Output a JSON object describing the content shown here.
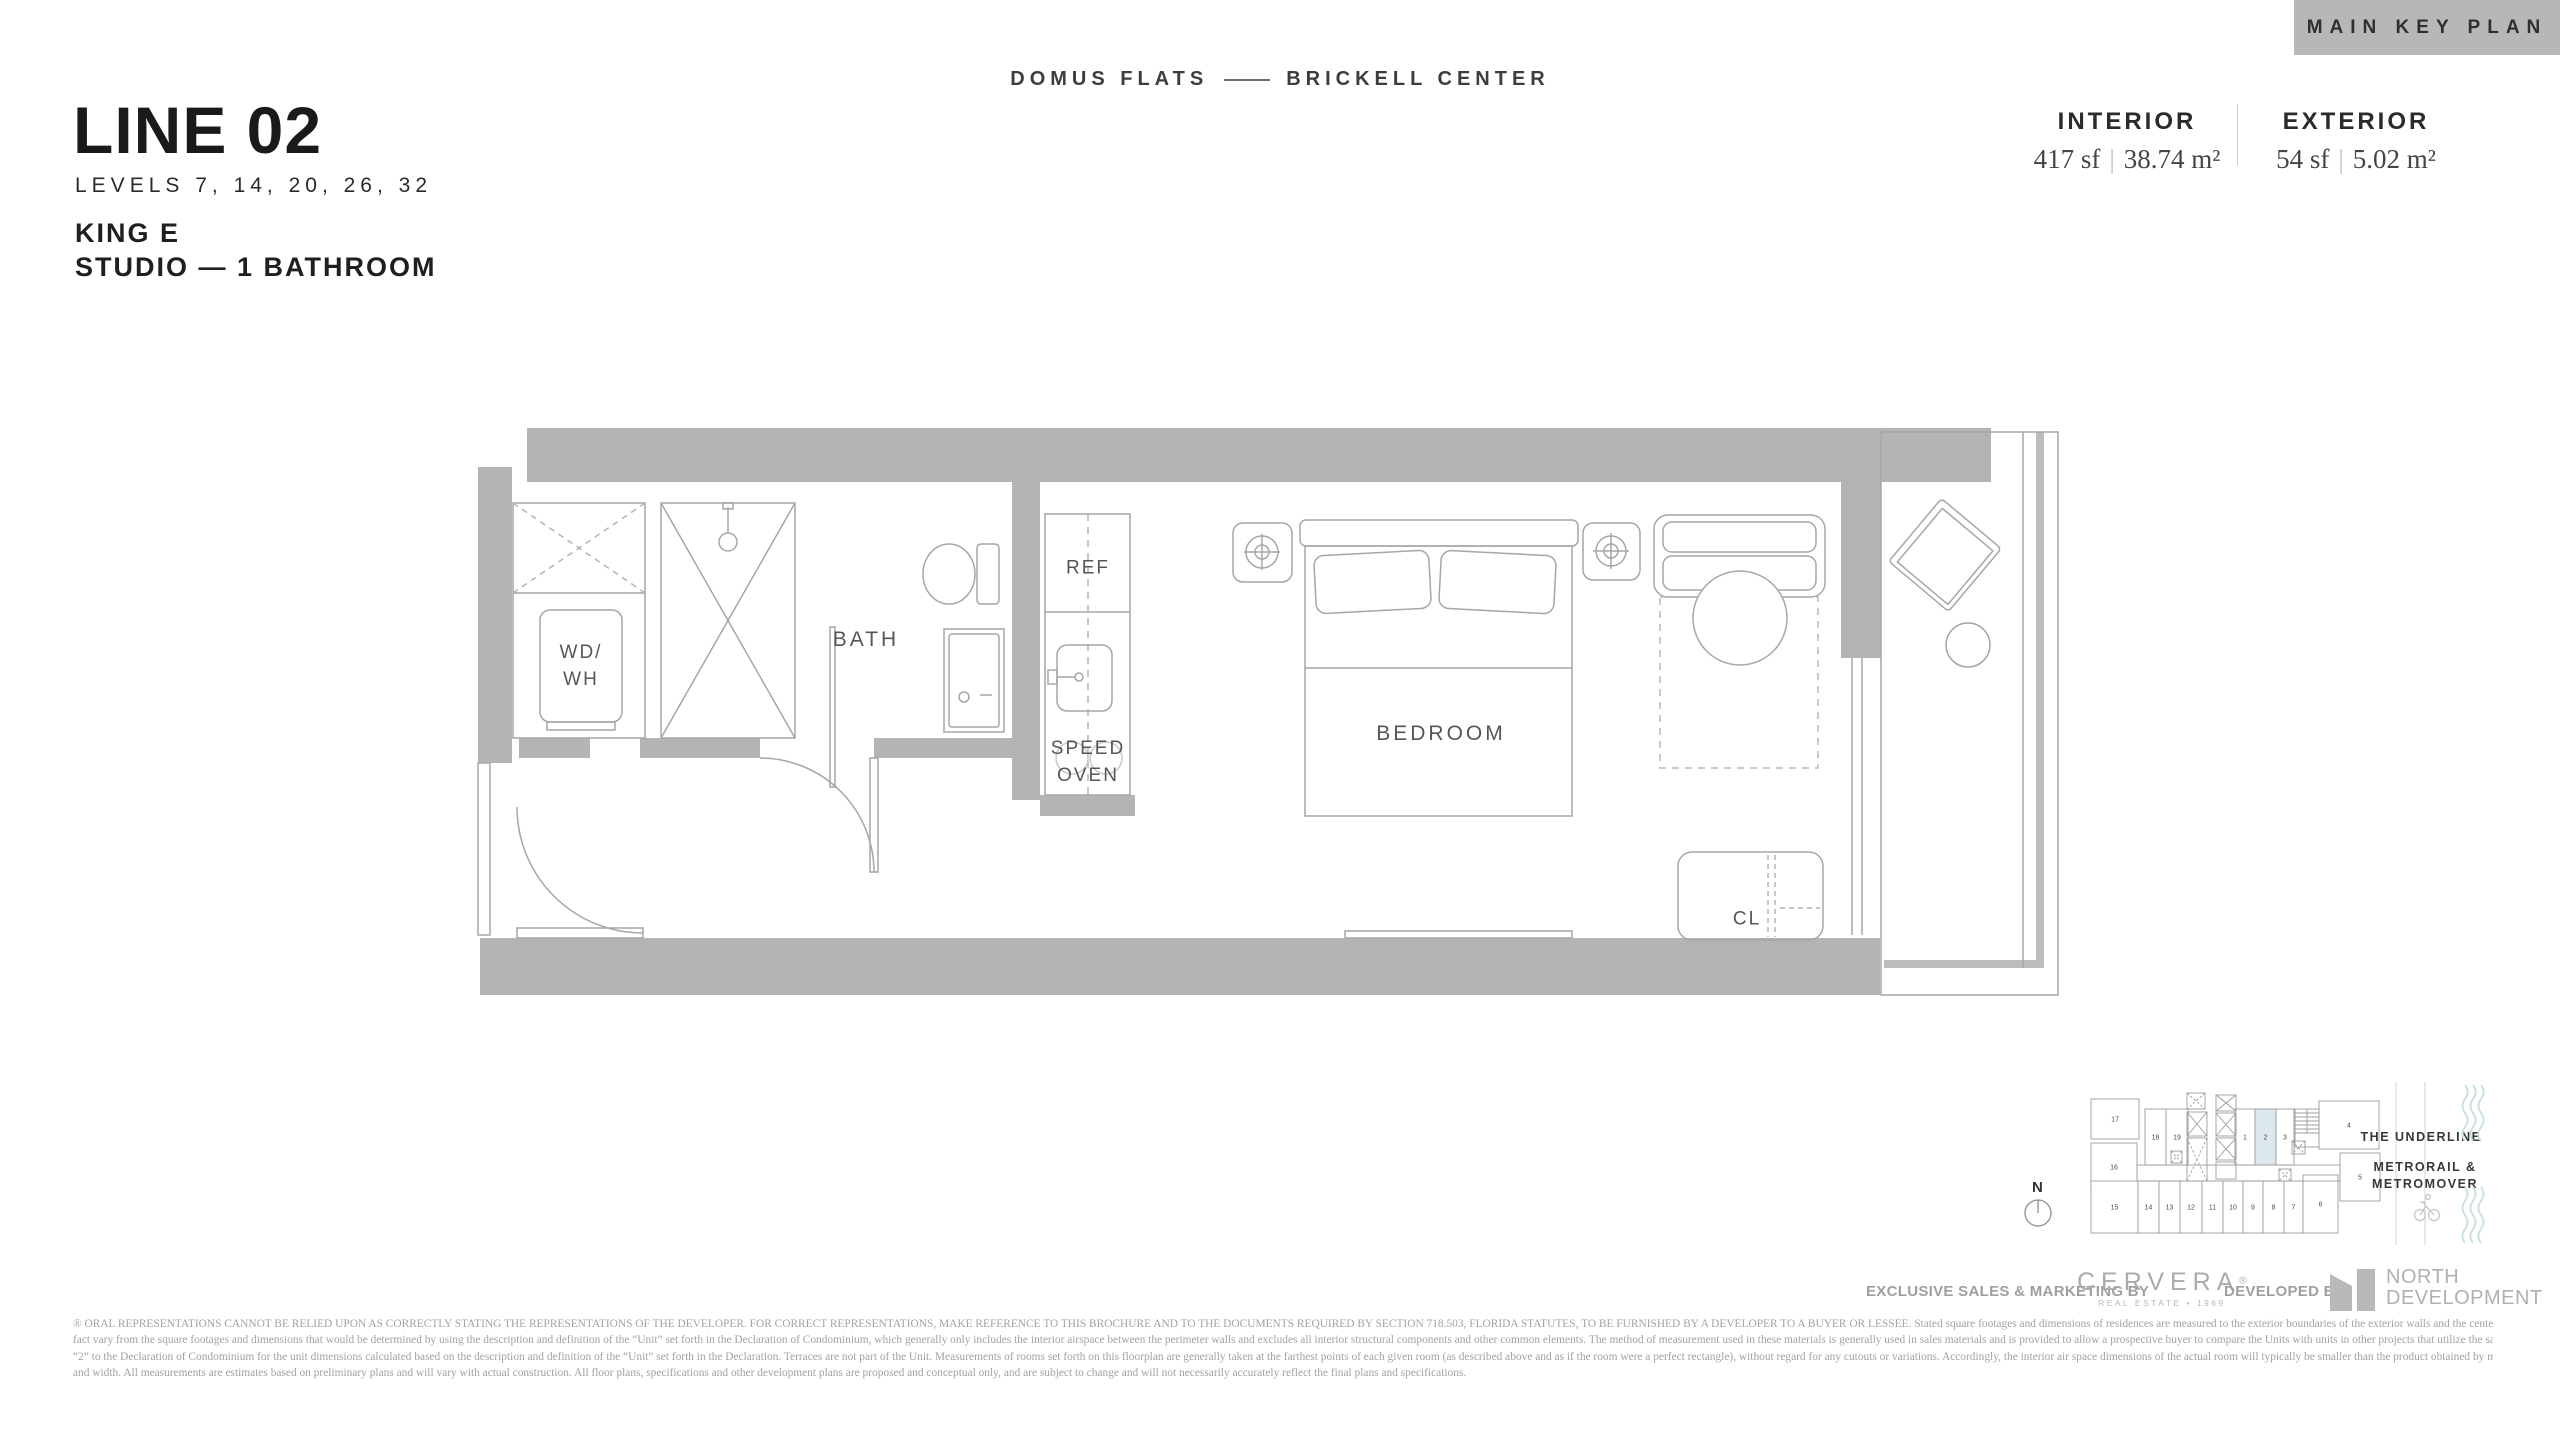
{
  "header": {
    "key_plan_button": "MAIN KEY PLAN",
    "brand_left": "DOMUS FLATS",
    "brand_right": "BRICKELL CENTER"
  },
  "title": {
    "line": "LINE 02",
    "levels": "LEVELS 7, 14, 20, 26, 32",
    "unit_name": "KING E",
    "unit_type": "STUDIO — 1 BATHROOM"
  },
  "areas": {
    "interior_label": "INTERIOR",
    "interior_sf": "417 sf",
    "interior_m2": "38.74 m²",
    "exterior_label": "EXTERIOR",
    "exterior_sf": "54 sf",
    "exterior_m2": "5.02 m²",
    "divider": "|"
  },
  "plan": {
    "labels": {
      "wd1": "WD/",
      "wd2": "WH",
      "bath": "BATH",
      "ref": "REF",
      "speed1": "SPEED",
      "speed2": "OVEN",
      "bedroom": "BEDROOM",
      "cl": "CL"
    }
  },
  "key_plan": {
    "north_label": "N",
    "annotations": {
      "underline": "THE UNDERLINE",
      "metro1": "METRORAIL &",
      "metro2": "METROMOVER"
    },
    "highlight_color": "#dce8ed",
    "highlighted_unit": "2",
    "units": [
      {
        "label": "17",
        "x": 8,
        "y": 14,
        "w": 48,
        "h": 40
      },
      {
        "label": "16",
        "x": 8,
        "y": 58,
        "w": 46,
        "h": 48
      },
      {
        "label": "18",
        "x": 62,
        "y": 24,
        "w": 21,
        "h": 56
      },
      {
        "label": "19",
        "x": 83,
        "y": 24,
        "w": 22,
        "h": 56
      },
      {
        "label": "1",
        "x": 152,
        "y": 24,
        "w": 20,
        "h": 56
      },
      {
        "label": "2",
        "x": 172,
        "y": 24,
        "w": 21,
        "h": 56,
        "highlighted": true
      },
      {
        "label": "3",
        "x": 193,
        "y": 24,
        "w": 18,
        "h": 56
      },
      {
        "label": "4",
        "x": 236,
        "y": 16,
        "w": 60,
        "h": 48
      },
      {
        "label": "5",
        "x": 257,
        "y": 68,
        "w": 40,
        "h": 48
      },
      {
        "label": "15",
        "x": 8,
        "y": 96,
        "w": 47,
        "h": 52
      },
      {
        "label": "14",
        "x": 55,
        "y": 96,
        "w": 21,
        "h": 52
      },
      {
        "label": "13",
        "x": 76,
        "y": 96,
        "w": 21,
        "h": 52
      },
      {
        "label": "12",
        "x": 97,
        "y": 96,
        "w": 22,
        "h": 52
      },
      {
        "label": "11",
        "x": 119,
        "y": 96,
        "w": 21,
        "h": 52
      },
      {
        "label": "10",
        "x": 140,
        "y": 96,
        "w": 20,
        "h": 52
      },
      {
        "label": "9",
        "x": 160,
        "y": 96,
        "w": 20,
        "h": 52
      },
      {
        "label": "8",
        "x": 180,
        "y": 96,
        "w": 21,
        "h": 52
      },
      {
        "label": "7",
        "x": 201,
        "y": 96,
        "w": 19,
        "h": 52
      },
      {
        "label": "6",
        "x": 220,
        "y": 90,
        "w": 35,
        "h": 58
      }
    ]
  },
  "footer": {
    "sales_label": "EXCLUSIVE SALES & MARKETING BY",
    "cervera_name": "CERVERA",
    "cervera_reg": "®",
    "cervera_sub": "REAL ESTATE • 1969",
    "developed_label": "DEVELOPED BY",
    "developer_name1": "NORTH",
    "developer_name2": "DEVELOPMENT"
  },
  "disclaimer": {
    "lines": [
      "® ORAL REPRESENTATIONS CANNOT BE RELIED UPON AS CORRECTLY STATING THE REPRESENTATIONS OF THE DEVELOPER. FOR CORRECT REPRESENTATIONS, MAKE REFERENCE TO THIS BROCHURE AND TO THE DOCUMENTS REQUIRED BY SECTION 718.503, FLORIDA STATUTES, TO BE FURNISHED BY A DEVELOPER TO A BUYER OR LESSEE. Stated square footages and dimensions of residences are measured to the exterior boundaries of the exterior walls and the centerline of interior demising walls between units and in",
      "fact vary from the square footages and dimensions that would be determined by using the description and definition of the “Unit” set forth in the Declaration of Condominium, which generally only includes the interior airspace between the perimeter walls and excludes all interior structural components and other common elements.  The method of measurement used in these materials is generally used in sales materials and is provided to allow a prospective buyer to compare the Units with units in other projects that utilize the same method. Refer to Exhibit",
      "“2” to the Declaration of Condominium for the unit dimensions calculated based on the description and definition of the “Unit” set forth in the Declaration. Terraces are not part of the Unit.  Measurements of rooms set forth on this floorplan are generally taken at the farthest points of each given room (as described above and as if the room were a perfect rectangle), without regard for any cutouts or variations.  Accordingly, the interior air space dimensions of the actual room will typically be smaller than the product obtained by multiplying the stated length",
      "and width.  All measurements are estimates based on preliminary plans and will vary with actual construction. All floor plans, specifications and other development plans are proposed and conceptual only, and are subject to change and will not necessarily accurately reflect the final plans and specifications."
    ]
  },
  "colors": {
    "wall_gray": "#b3b4b4",
    "button_gray": "#b7b7b7",
    "highlight_blue": "#dce8ed",
    "wave_teal": "#cbe3e0"
  }
}
